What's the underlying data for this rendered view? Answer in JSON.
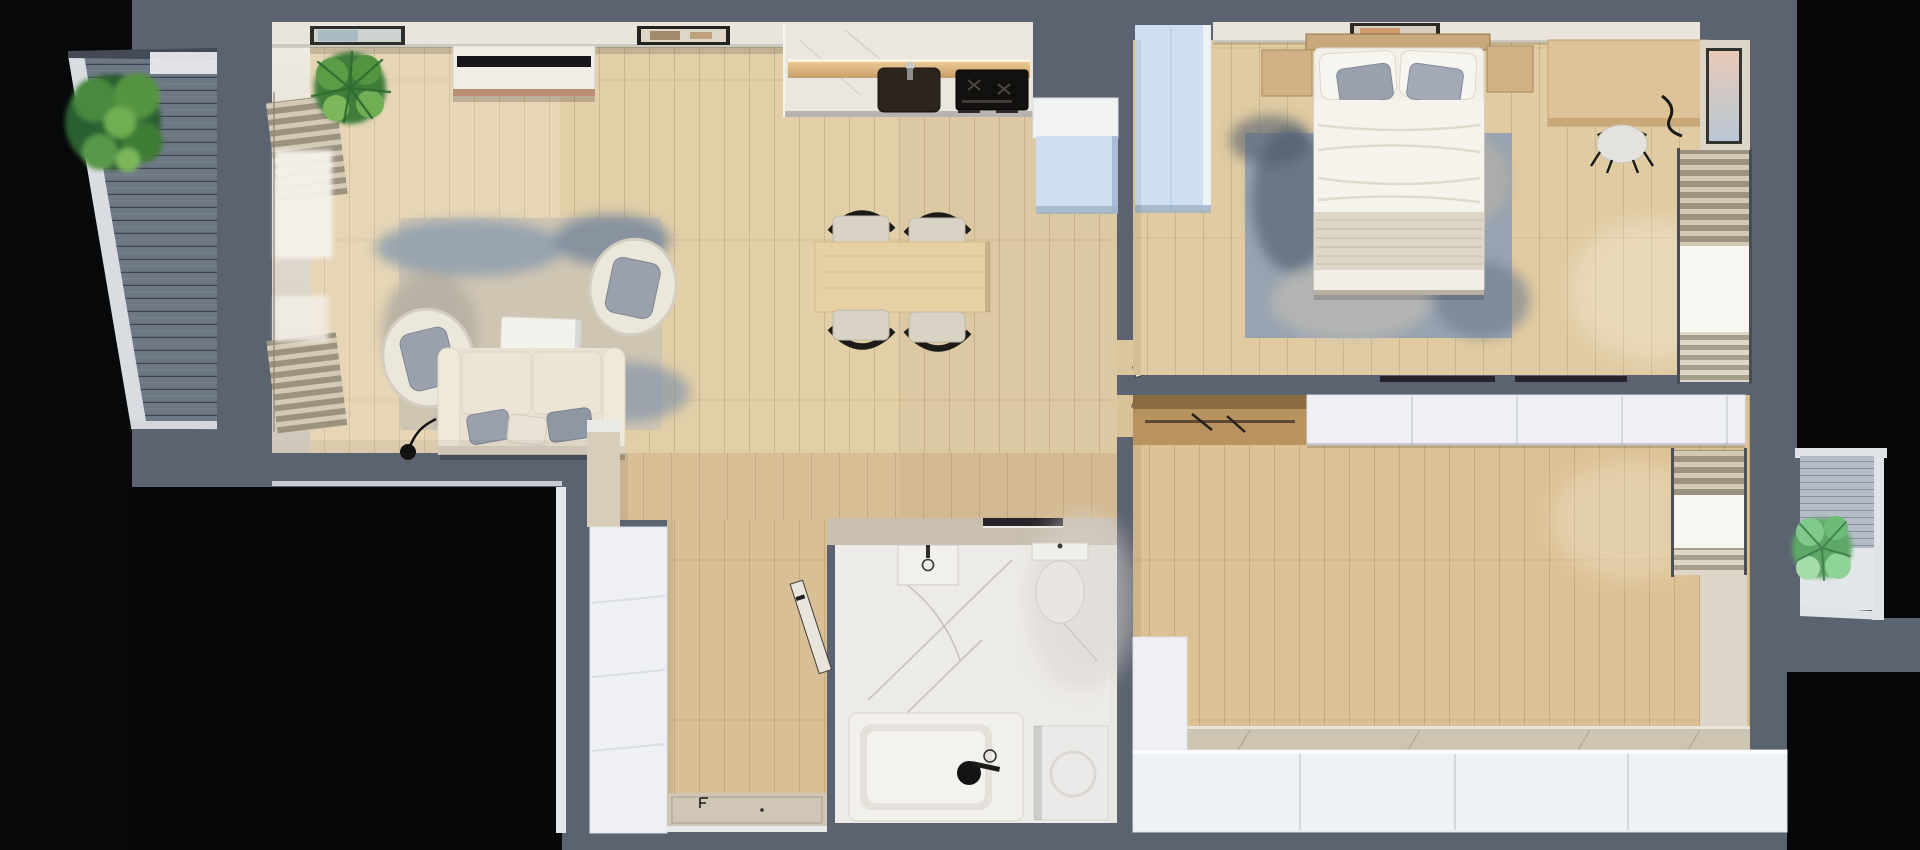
{
  "image": {
    "kind": "3d-floor-plan-top-down-render",
    "width_px": 1920,
    "height_px": 850,
    "visible_text": []
  },
  "colors": {
    "wall": "#5b6270",
    "outside": "#060708",
    "floor_main": "#e2cfa8",
    "floor_hall": "#d8bf96",
    "floor_bedroom": "#e0cba2",
    "floor_room2": "#dcc194",
    "deck_left": "#6e7885",
    "deck_right_wall": "#b4bcc6",
    "deck_right_floor": "#e4e7ea",
    "frame_white": "#dfe3e8",
    "wall_face": "#e9e5dd",
    "wall_face_beige": "#ddd5c8",
    "cabinet_white": "#eef0f4",
    "cabinet_blue": "#cfdff2",
    "counter_marble": "#ebe7e0",
    "counter_wood": "#d9b382",
    "appliance_dark": "#131110",
    "sink_dark": "#2b251e",
    "table_wood": "#e7d1a3",
    "chair_seat": "#d9d3c5",
    "chair_frame": "#1d1b18",
    "sofa": "#e9e2d2",
    "cushion_gray": "#9aa1ad",
    "rug_living": "#cfc5b3",
    "rug_blue": "#8e9dae",
    "rug_bedroom": "#98a3b1",
    "bed_white": "#f3f0e9",
    "blanket": "#ded7c8",
    "headboard": "#c9a87c",
    "nightstand": "#d2b184",
    "desk": "#dfc398",
    "marble": "#edebe7",
    "fixture_white": "#f2f0ec",
    "door_leaf": "#e9e5dd",
    "threshold": "#cfc6b6",
    "wardrobe_wood": "#b9935f",
    "window_light": "#f8f6f1",
    "blind_beige": "#cfc6b6",
    "plant_dark": "#2c5e31",
    "plant_mid": "#4c8c3f",
    "plant_light": "#7cb75b",
    "track_dark": "#26242a",
    "tv_black": "#17161a",
    "lamp_black": "#141414"
  },
  "scene": {
    "rooms": [
      {
        "id": "balcony-left",
        "contents": [
          "plant",
          "wood-decking",
          "white-parapet"
        ]
      },
      {
        "id": "living-room",
        "contents": [
          "tv-sideboard",
          "wall-art",
          "plant",
          "roman-blinds",
          "rug",
          "armchair",
          "armchair",
          "coffee-table",
          "sofa",
          "floor-lamp"
        ]
      },
      {
        "id": "kitchen-dining",
        "contents": [
          "counter",
          "sink",
          "cooktop",
          "wall-art",
          "fridge-cabinet",
          "dining-table",
          "chair",
          "chair",
          "chair",
          "chair"
        ]
      },
      {
        "id": "hallway",
        "contents": [
          "wardrobe",
          "entrance-door",
          "threshold"
        ]
      },
      {
        "id": "bathroom",
        "contents": [
          "washbasin",
          "toilet",
          "bathtub",
          "washing-machine",
          "sliding-door-track"
        ]
      },
      {
        "id": "bedroom",
        "contents": [
          "blue-wardrobe",
          "bed",
          "pillows",
          "nightstand",
          "nightstand",
          "rug",
          "desk",
          "desk-chair",
          "window-blinds",
          "wall-art",
          "door"
        ]
      },
      {
        "id": "room-2",
        "contents": [
          "open-wardrobe",
          "white-wardrobe-row",
          "window-blinds",
          "bottom-cabinets",
          "door"
        ]
      },
      {
        "id": "balcony-right",
        "contents": [
          "plant",
          "decking",
          "white-parapet"
        ]
      }
    ],
    "dining_chairs_count": 4,
    "doors_count": 3
  }
}
